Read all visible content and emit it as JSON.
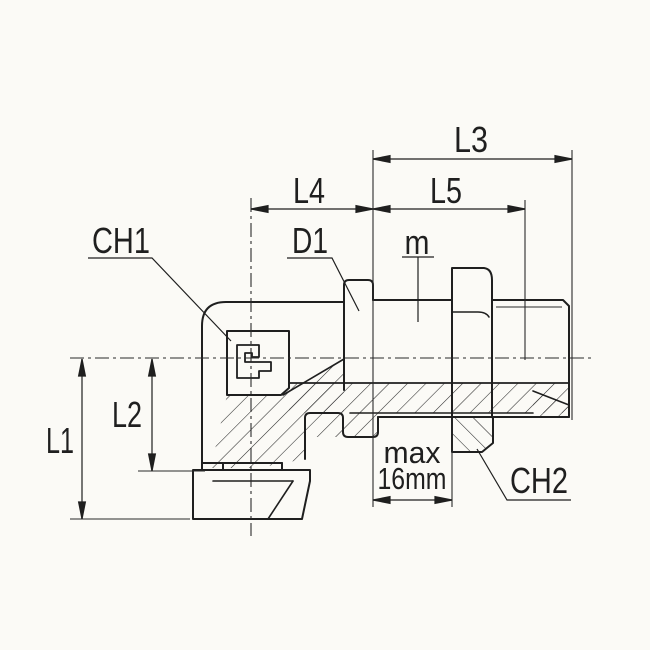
{
  "drawing": {
    "dimension_labels": {
      "l1": "L1",
      "l2": "L2",
      "l3": "L3",
      "l4": "L4",
      "l5": "L5"
    },
    "feature_labels": {
      "ch1": "CH1",
      "ch2": "CH2",
      "d1": "D1",
      "m": "m"
    },
    "note": {
      "line1": "max",
      "line2": "16mm"
    },
    "colors": {
      "line": "#1f1f1f",
      "thin_line": "#2a2a2a",
      "background": "#fbfaf6"
    }
  }
}
